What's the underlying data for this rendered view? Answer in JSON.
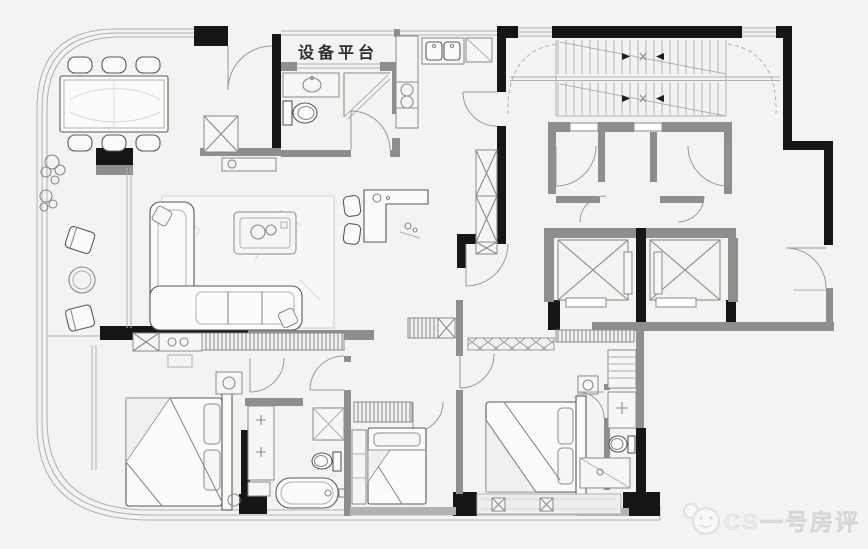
{
  "labels": {
    "platform": "设备平台",
    "watermark": "CS一号房评"
  },
  "colors": {
    "bg": "#f3f3f1",
    "wall": "#161616",
    "part": "#8e8e8c",
    "part2": "#b2b2b0",
    "line": "#8a8a88",
    "thin": "#b0b0ae",
    "furn": "#fbfbfa",
    "furnstroke": "#5a5a58",
    "tex": "#d9d9d7",
    "wm": "#ececea",
    "wmline": "#d6d6d4",
    "label": "#2e2e2e"
  }
}
